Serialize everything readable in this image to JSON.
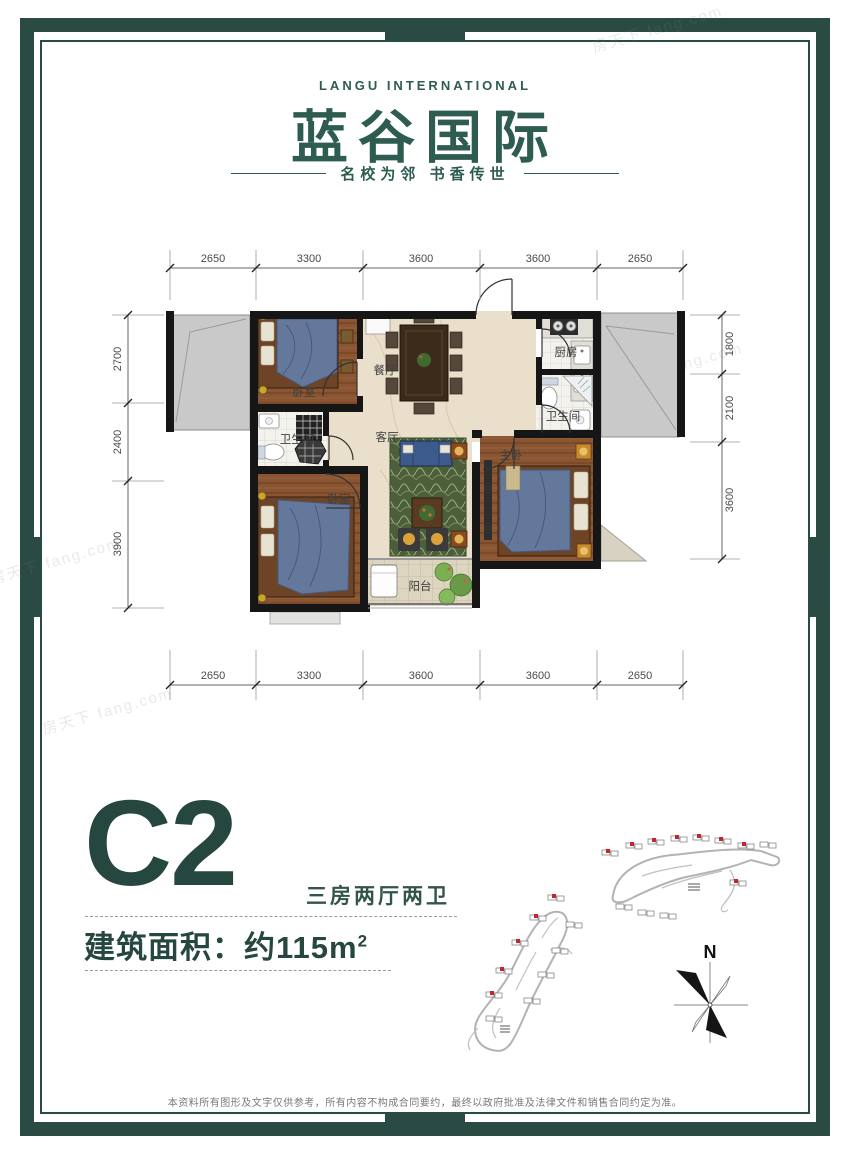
{
  "brand": {
    "en": "LANGU INTERNATIONAL",
    "zh": "蓝谷国际",
    "tagline": "名校为邻  书香传世"
  },
  "plan": {
    "dims_top": [
      "2650",
      "3300",
      "3600",
      "3600",
      "2650"
    ],
    "dims_bottom": [
      "2650",
      "3300",
      "3600",
      "3600",
      "2650"
    ],
    "dims_left": [
      "2700",
      "2400",
      "3900"
    ],
    "dims_right": [
      "1800",
      "2100",
      "3600"
    ],
    "rooms": {
      "bedroom1": "卧室",
      "dining": "餐厅",
      "kitchen": "厨房",
      "bath1": "卫生间",
      "bath2": "卫生间",
      "living": "客厅",
      "master": "主卧",
      "bedroom2": "卧室",
      "balcony": "阳台"
    }
  },
  "unit": {
    "name": "C2",
    "layout": "三房两厅两卫",
    "area_label": "建筑面积：约115m",
    "area_sup": "2"
  },
  "compass": {
    "label": "N"
  },
  "footer": {
    "disclaimer": "本资料所有图形及文字仅供参考，所有内容不构成合同要约，最终以政府批准及法律文件和销售合同约定为准。"
  },
  "watermark": {
    "text": "房天下 fang.com"
  },
  "colors": {
    "frame": "#2a4a44",
    "brand": "#2e5c51",
    "accent": "#26473f",
    "highlight_red": "#c1272d"
  }
}
